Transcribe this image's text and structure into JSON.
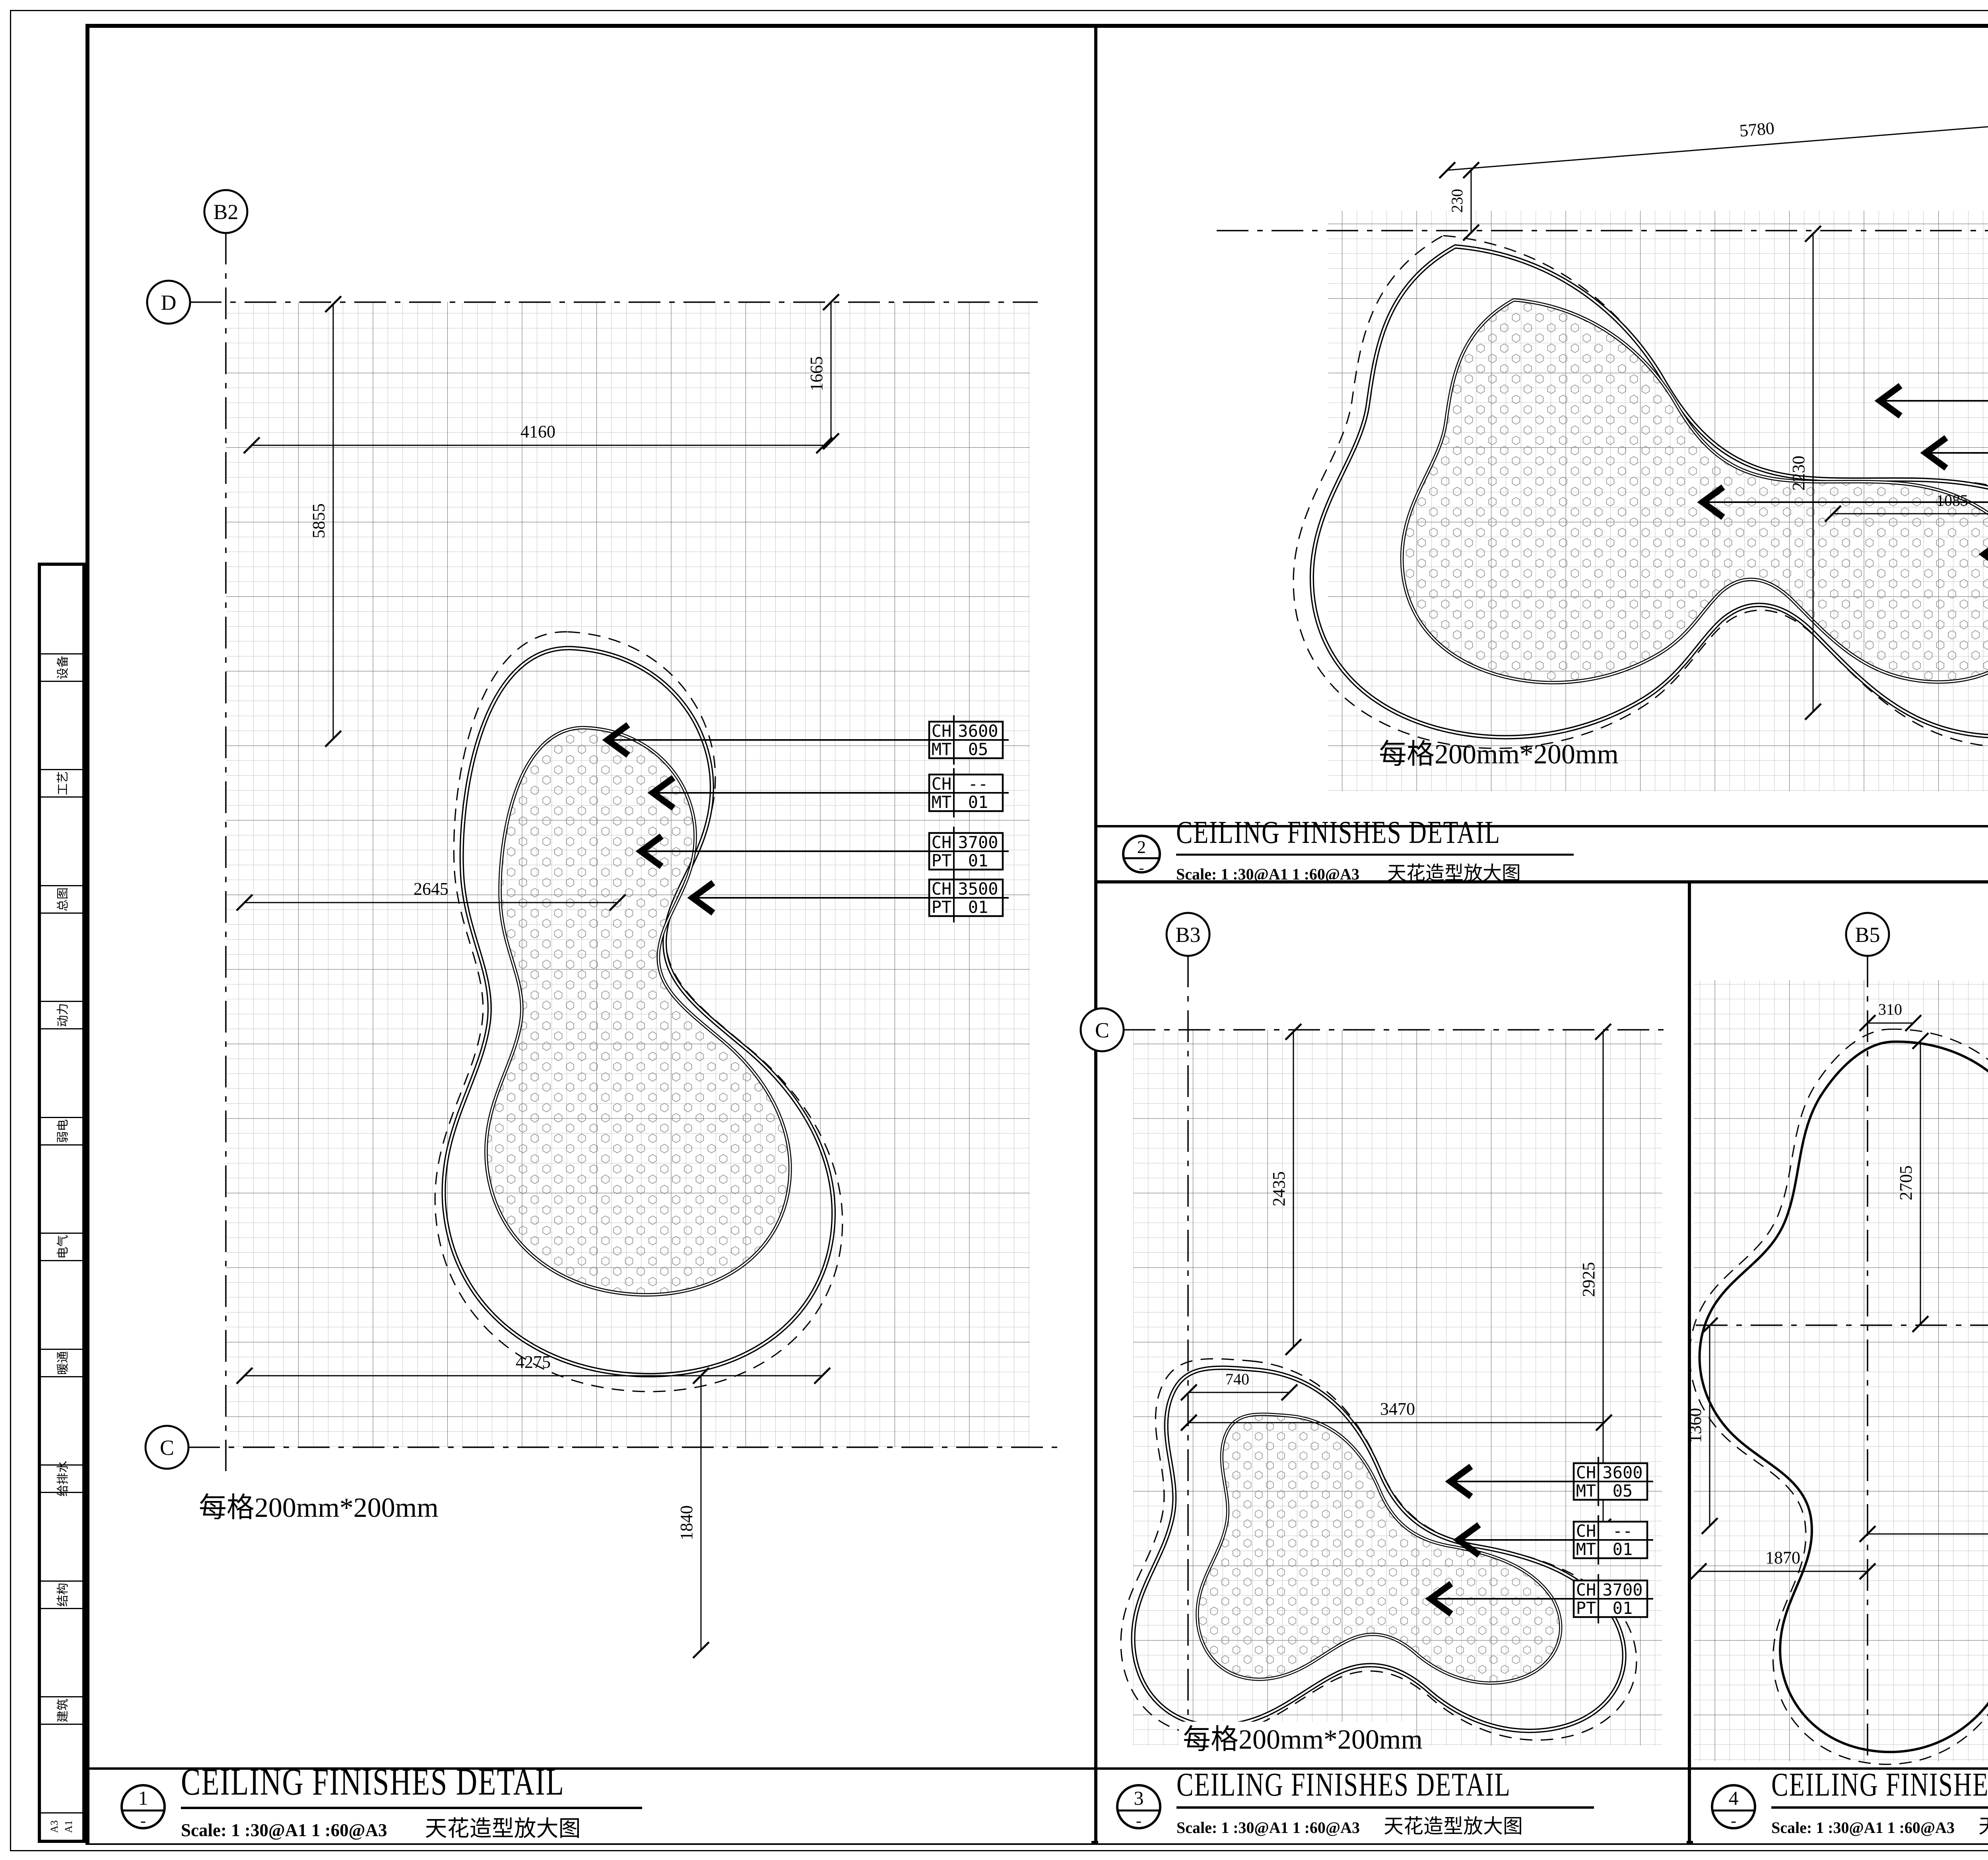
{
  "sidebar": {
    "items": [
      "设备",
      "工艺",
      "总图",
      "动力",
      "弱电",
      "电气",
      "暖通",
      "给排水",
      "结构",
      "建筑"
    ],
    "sheet_a3": "A3",
    "sheet_a1": "A1"
  },
  "panels": [
    {
      "num": "1",
      "dash": "-",
      "title": "CEILING FINISHES DETAIL",
      "scale_line": "Scale: 1 :30@A1 1 :60@A3",
      "title_cn": "天花造型放大图",
      "grid_note": "每格200mm*200mm",
      "bubbles": [
        "B2",
        "D",
        "C"
      ],
      "dims": [
        "4160",
        "1665",
        "5855",
        "2645",
        "4275",
        "1840"
      ],
      "tags": [
        [
          "CH",
          "3600",
          "MT",
          "05"
        ],
        [
          "CH",
          "--",
          "MT",
          "01"
        ],
        [
          "CH",
          "3700",
          "PT",
          "01"
        ],
        [
          "CH",
          "3500",
          "PT",
          "01"
        ]
      ]
    },
    {
      "num": "2",
      "dash": "-",
      "title": "CEILING FINISHES DETAIL",
      "scale_line": "Scale: 1 :30@A1 1 :60@A3",
      "title_cn": "天花造型放大图",
      "grid_note": "每格200mm*200mm",
      "bubbles": [
        "B4",
        "F"
      ],
      "dims": [
        "5780",
        "230",
        "2230",
        "1085"
      ],
      "tags": [
        [
          "CH",
          "3600",
          "MT",
          "05"
        ],
        [
          "CH",
          "--",
          "MT",
          "01"
        ],
        [
          "CH",
          "3700",
          "PT",
          "01"
        ],
        [
          "CH",
          "3500",
          "PT",
          "01"
        ]
      ]
    },
    {
      "num": "3",
      "dash": "-",
      "title": "CEILING FINISHES DETAIL",
      "scale_line": "Scale: 1 :30@A1 1 :60@A3",
      "title_cn": "天花造型放大图",
      "grid_note": "每格200mm*200mm",
      "bubbles": [
        "B3",
        "C"
      ],
      "dims": [
        "2435",
        "2925",
        "740",
        "3470"
      ],
      "tags": [
        [
          "CH",
          "3600",
          "MT",
          "05"
        ],
        [
          "CH",
          "--",
          "MT",
          "01"
        ],
        [
          "CH",
          "3700",
          "PT",
          "01"
        ]
      ]
    },
    {
      "num": "4",
      "dash": "-",
      "title": "CEILING FINISHES DETAIL",
      "scale_line": "Scale: 1 :30@A1 1 :60@A3",
      "title_cn": "天花造型放大图",
      "bubbles": [
        "B5",
        "G"
      ],
      "dims": [
        "310",
        "2705",
        "1360",
        "860",
        "3740",
        "1870"
      ],
      "tags": [
        [
          "CH",
          "3500",
          "PT",
          "01"
        ],
        [
          "CH",
          "3700",
          "PT",
          "01"
        ]
      ]
    }
  ],
  "titleblock": {
    "firm_cn": "上海颐景建筑设计有限公司",
    "firm_en": "Shanghai YiJing Architecture Design Co.,Ltd",
    "cert1": "建筑工程甲级 证书编号 A131003669",
    "cert2": "风景园林乙级 证书编号 A231003666",
    "partner_label": "合作设计单位:",
    "logo_line1": "A+DESIGN™",
    "logo_line2": "ASSOCIATES",
    "logo_plus": "+",
    "logo_a": "A",
    "partner_cn": "新珈建筑室内设计（上海）有限公司",
    "partner_en": "A+ Desigh Associates Limited",
    "partner_addr_cn": "虹口区乍浦路89号，星荟中心1座1203室",
    "partner_addr1": "Landmark Center,Unit 1203",
    "partner_addr2": "Building 1,No.89,Zhapu Road",
    "partner_addr3": "中国上海  Shanghai,China",
    "partner_web": "www.aplusdesign.com",
    "huiqian_label": "会签:",
    "stamp_label": "出图签章:",
    "license_label": "注册执业章:",
    "notes_label": "备注:",
    "note_bold": "本图为设计意向图仅用于表示精装修饰面",
    "notes": [
      "图中所示材料安装结构及厚度仅供参考；",
      "所有的节点必须符合当地的相关规范；",
      "所有装饰材料结构安装构造必须经过结构工程师",
      "审批；",
      "详情参见本图的设计说明。"
    ],
    "ver_col1": "版本",
    "ver_col2": "升版原因",
    "ver_col3": "升版日期",
    "ver_note": "本图升版后，以最高版本为准",
    "client_label": "建设单位:",
    "client": "海旅免税城（三亚）迎宾有限公司",
    "project_label": "工程名称:",
    "project": "海旅免税城5F改造项目",
    "sub_label": "子项名称:",
    "drawing_label": "图名:",
    "drawing": "天花放样图5",
    "projno_label": "工程编号:",
    "projno": "ASJ21010",
    "people": [
      {
        "role": "项目负责人",
        "name": "王辉"
      },
      {
        "role": "审定人",
        "name": "王辉"
      },
      {
        "role": "审核人",
        "name": "王辉"
      },
      {
        "role": "专业负责人",
        "name": "王辉"
      },
      {
        "role": "校对人",
        "name": "胡旭燕"
      },
      {
        "role": "设计人",
        "name": "李勇"
      },
      {
        "role": "制图人",
        "name": "李勇"
      }
    ],
    "major_label": "专业:",
    "major": "装饰",
    "fig_label": "图号:",
    "figno": "ID-500-208",
    "stage_label": "阶段:",
    "stage": "施工图",
    "scale_label": "比例:",
    "scale": "N/A",
    "date_label": "日期:",
    "date": "2021.05.17",
    "file_label": "文件名:"
  }
}
